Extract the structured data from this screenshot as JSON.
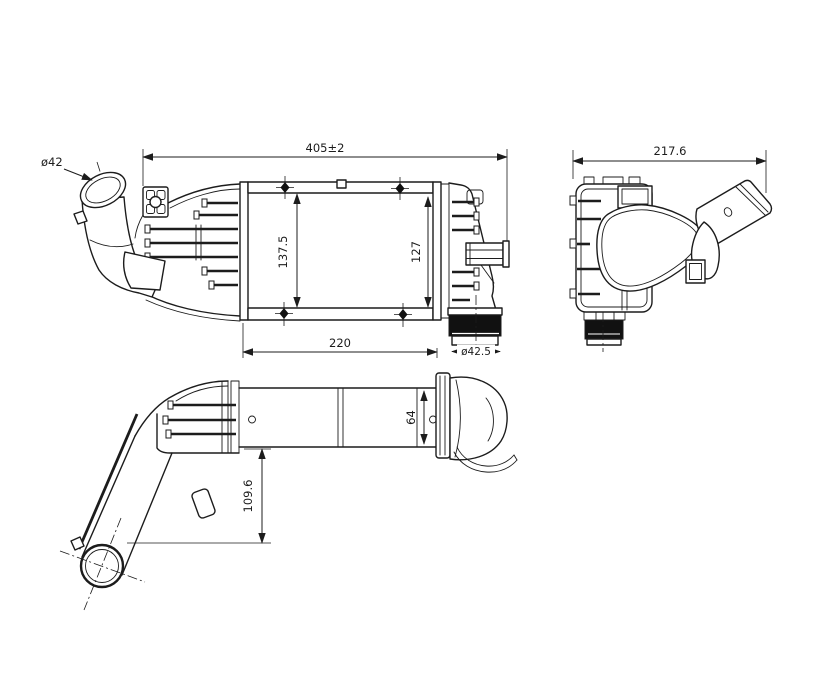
{
  "meta": {
    "title": "Intercooler technical drawing, three orthographic views"
  },
  "colors": {
    "background": "#ffffff",
    "line": "#1c1c1c",
    "dark_fill": "#111111"
  },
  "views": {
    "front": {
      "name": "front view",
      "labels": {
        "inlet_diameter": "ø42",
        "overall_width": "405±2",
        "height_left": "137.5",
        "height_right": "127",
        "core_width": "220",
        "outlet_diameter": "ø42.5"
      }
    },
    "side": {
      "name": "side view",
      "labels": {
        "overall_depth": "217.6"
      }
    },
    "bottom": {
      "name": "bottom view",
      "labels": {
        "end_tank_width": "64",
        "pipe_center_offset": "109.6"
      }
    }
  }
}
